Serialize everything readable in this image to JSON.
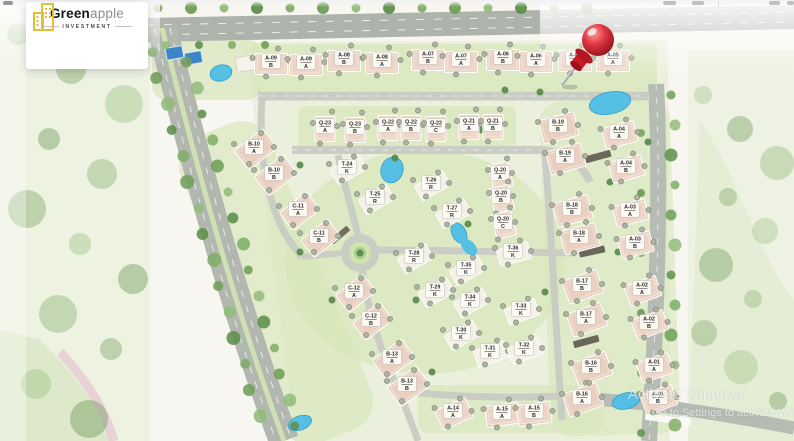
{
  "brand": {
    "name_bold": "Green",
    "name_light": "apple",
    "tagline": "INVESTMENT",
    "logo_color": "#e2bf35"
  },
  "watermark": {
    "line1": "Activate Windows",
    "line2": "Go to Settings to activate Windows."
  },
  "map": {
    "pin": {
      "shape": "red-pushpin",
      "points_at": "A-05",
      "color": "#c8101d"
    },
    "colors": {
      "roof_pink": "#ecd4c6",
      "roof_white": "#f3eee3",
      "lawn": "#d7e7ba",
      "road": "#b2b7af",
      "water": "#56c0e4",
      "badge_bg": "#fcfaf4",
      "badge_text": "#2d2d2d"
    },
    "buildings": [
      [
        "A-09",
        "B",
        271,
        61,
        0
      ],
      [
        "A-09",
        "A",
        306,
        62,
        0
      ],
      [
        "A-08",
        "B",
        344,
        58,
        0
      ],
      [
        "A-08",
        "A",
        382,
        60,
        0
      ],
      [
        "A-07",
        "B",
        428,
        57,
        0
      ],
      [
        "A-07",
        "A",
        461,
        59,
        0
      ],
      [
        "A-06",
        "B",
        503,
        57,
        0
      ],
      [
        "A-06",
        "A",
        536,
        59,
        0
      ],
      [
        "A-05",
        "B",
        575,
        58,
        0
      ],
      [
        "A-05",
        "A",
        613,
        58,
        0
      ],
      [
        "Q-23",
        "A",
        325,
        126,
        0
      ],
      [
        "Q-23",
        "B",
        355,
        127,
        0
      ],
      [
        "Q-22",
        "A",
        388,
        125,
        0
      ],
      [
        "Q-22",
        "B",
        411,
        125,
        0
      ],
      [
        "Q-22",
        "C",
        436,
        126,
        0
      ],
      [
        "Q-21",
        "A",
        469,
        124,
        0
      ],
      [
        "Q-21",
        "B",
        493,
        124,
        0
      ],
      [
        "B-19",
        "B",
        558,
        125,
        -15
      ],
      [
        "B-19",
        "A",
        565,
        156,
        -15
      ],
      [
        "A-04",
        "A",
        619,
        132,
        -15
      ],
      [
        "A-04",
        "B",
        626,
        166,
        -15
      ],
      [
        "Q-20",
        "A",
        500,
        173,
        -15
      ],
      [
        "Q-20",
        "B",
        501,
        196,
        -15
      ],
      [
        "Q-20",
        "C",
        503,
        222,
        -15
      ],
      [
        "B-18",
        "B",
        572,
        208,
        -15
      ],
      [
        "B-18",
        "A",
        579,
        236,
        -15
      ],
      [
        "A-03",
        "A",
        630,
        210,
        -15
      ],
      [
        "A-03",
        "B",
        635,
        242,
        -15
      ],
      [
        "B-17",
        "B",
        582,
        284,
        -20
      ],
      [
        "B-17",
        "A",
        586,
        317,
        -20
      ],
      [
        "A-02",
        "A",
        642,
        288,
        -20
      ],
      [
        "A-02",
        "B",
        649,
        322,
        -20
      ],
      [
        "B-16",
        "B",
        591,
        366,
        -20
      ],
      [
        "B-16",
        "A",
        582,
        397,
        -20
      ],
      [
        "A-01",
        "A",
        654,
        365,
        -20
      ],
      [
        "A-01",
        "B",
        658,
        397,
        -20
      ],
      [
        "B-10",
        "A",
        254,
        147,
        -38
      ],
      [
        "B-10",
        "B",
        274,
        173,
        -38
      ],
      [
        "C-11",
        "A",
        298,
        209,
        -38
      ],
      [
        "C-11",
        "B",
        319,
        236,
        -38
      ],
      [
        "C-12",
        "A",
        354,
        291,
        -38
      ],
      [
        "C-12",
        "B",
        371,
        319,
        -38
      ],
      [
        "B-13",
        "A",
        392,
        357,
        -36
      ],
      [
        "B-13",
        "B",
        407,
        384,
        -36
      ],
      [
        "A-14",
        "A",
        453,
        411,
        -25
      ],
      [
        "A-15",
        "A",
        502,
        412,
        -8
      ],
      [
        "A-15",
        "B",
        534,
        411,
        -8
      ],
      [
        "T-24",
        "K",
        347,
        167,
        -30
      ],
      [
        "T-25",
        "R",
        375,
        197,
        -30
      ],
      [
        "T-26",
        "R",
        431,
        183,
        -30
      ],
      [
        "T-27",
        "R",
        452,
        211,
        -30
      ],
      [
        "T-28",
        "R",
        414,
        256,
        -30
      ],
      [
        "T-36",
        "K",
        513,
        251,
        -15
      ],
      [
        "T-35",
        "K",
        466,
        268,
        -30
      ],
      [
        "T-29",
        "K",
        435,
        290,
        -30
      ],
      [
        "T-34",
        "K",
        470,
        300,
        -30
      ],
      [
        "T-33",
        "K",
        521,
        309,
        -20
      ],
      [
        "T-30",
        "K",
        461,
        333,
        -30
      ],
      [
        "T-31",
        "K",
        490,
        351,
        -20
      ],
      [
        "T-32",
        "K",
        524,
        348,
        -20
      ]
    ]
  }
}
